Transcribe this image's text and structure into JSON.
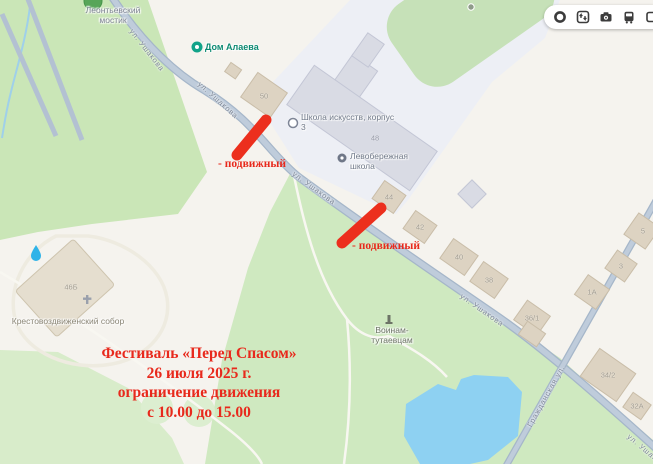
{
  "controls": {
    "icons": [
      "traffic-ring",
      "navigator-arrows",
      "camera",
      "bus",
      "panoramas"
    ]
  },
  "streets": {
    "ushakova": "ул. Ушакова",
    "grazhdanskaya": "Гражданская ул."
  },
  "poi": {
    "bridge": "Леонтьевский мостик",
    "alaev_house": "Дом Алаева",
    "art_school": "Школа искусств, корпус 3",
    "left_bank_school": "Левобережная школа",
    "cathedral": "Крестовоздвиженский собор",
    "war_memorial": "Воинам-тутаевцам"
  },
  "buildings": {
    "n50": "50",
    "n48": "48",
    "n44": "44",
    "n42": "42",
    "n40": "40",
    "n38": "38",
    "n36_1": "36/1",
    "n1a": "1А",
    "n3": "3",
    "n5": "5",
    "n34_2": "34/2",
    "n32a": "32А",
    "n46b": "46Б"
  },
  "annotations": {
    "movable": "- подвижный",
    "festival_line1": "Фестиваль «Перед Спасом»",
    "festival_line2": "26 июля 2025 г.",
    "festival_line3": "ограничение движения",
    "festival_line4": "с 10.00 до 15.00",
    "accent_color": "#e8291c",
    "bar_color": "#ec2f1d"
  }
}
